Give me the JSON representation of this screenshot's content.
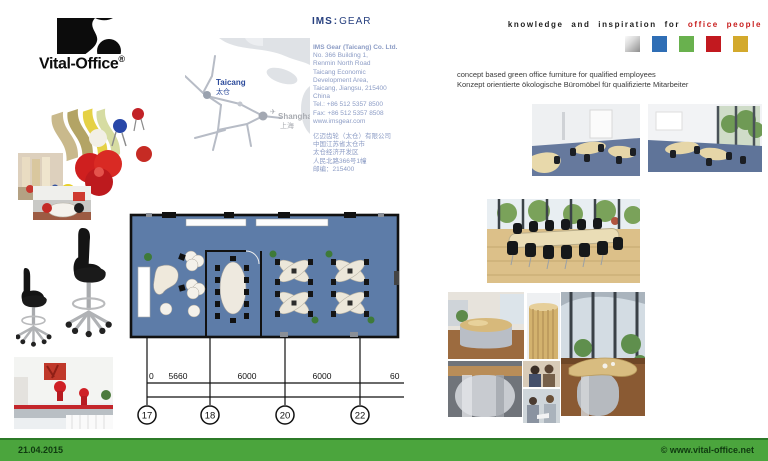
{
  "page": {
    "date": "21.04.2015",
    "copyright": "© www.vital-office.net"
  },
  "brand": {
    "name": "Vital-Office",
    "registered": "®"
  },
  "ims": {
    "word1": "IMS",
    "sep": ":",
    "word2": "GEAR"
  },
  "tagline": {
    "prefix": "knowledge and inspiration for ",
    "highlight": "office people"
  },
  "palette": {
    "silver": "#b5b5b5",
    "blue": "#2f6eb5",
    "green": "#69b14e",
    "red": "#c2191f",
    "gold": "#d3a92c",
    "footer_green": "#4ba53d",
    "tagline_red": "#c81d1d",
    "ims_blue": "#27407f",
    "contact_text": "#8c9cc5",
    "carpet_blue": "#5d7ca8"
  },
  "map": {
    "taicang_en": "Taicang",
    "taicang_zh": "太仓",
    "shanghai_plane": "✈",
    "shanghai_en": "Shanghai",
    "shanghai_zh": "上海"
  },
  "contact": {
    "lines": [
      "IMS Gear (Taicang) Co. Ltd.",
      "No. 366 Building 1,",
      "Renmin North Road",
      "Taicang Economic",
      "Development Area,",
      "Taicang, Jiangsu, 215400",
      "China",
      "Tel.: +86 512 5357 8500",
      "Fax: +86 512 5357 8508",
      "www.imsgear.com"
    ],
    "lines_zh": [
      "亿迈齿轮（太仓）有限公司",
      "中国江苏省太仓市",
      "太仓经济开发区",
      "人民北路366号1幢",
      "邮编：215400"
    ]
  },
  "concept": {
    "en": "concept based green office furniture for qualified employees",
    "de": "Konzept orientierte ökologische Büromöbel für qualifizierte Mitarbeiter"
  },
  "floorplan": {
    "dims": [
      "0",
      "5660",
      "6000",
      "6000",
      "60"
    ],
    "grid": [
      "17",
      "18",
      "20",
      "22"
    ]
  }
}
